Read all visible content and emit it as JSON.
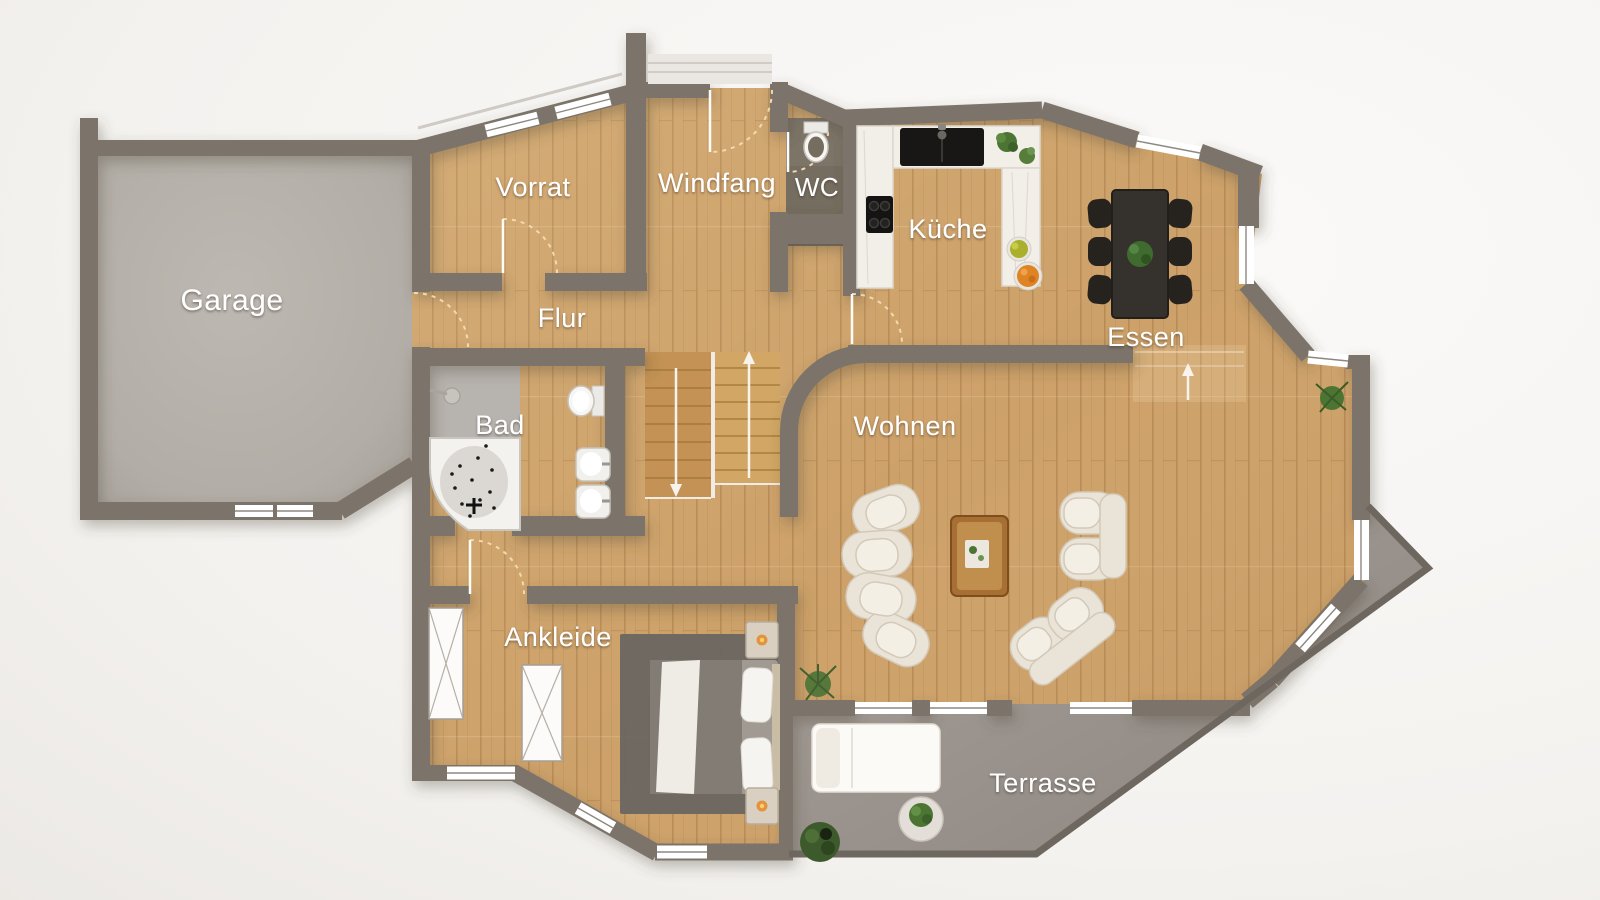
{
  "plan": {
    "type": "floor-plan",
    "floor": "ground-floor",
    "rooms": {
      "garage": {
        "label": "Garage"
      },
      "vorrat": {
        "label": "Vorrat"
      },
      "windfang": {
        "label": "Windfang"
      },
      "wc": {
        "label": "WC"
      },
      "kueche": {
        "label": "Küche"
      },
      "essen": {
        "label": "Essen"
      },
      "flur": {
        "label": "Flur"
      },
      "bad": {
        "label": "Bad"
      },
      "wohnen": {
        "label": "Wohnen"
      },
      "ankleide": {
        "label": "Ankleide"
      },
      "terrasse": {
        "label": "Terrasse"
      }
    },
    "icons": {
      "stairs_up_arrow": "up-arrow",
      "stairs_down_arrow": "down-arrow",
      "step_up_arrow": "up-arrow",
      "door_swing": "quarter-arc-dashed"
    },
    "colors": {
      "wall": "#7b736b",
      "wall_edge": "#6e675f",
      "wood_floor": "#cda169",
      "wood_plank_line": "#8a5d28",
      "garage_floor": "#b6b1aa",
      "terrace_floor": "#9b948d",
      "wc_floor": "#756d5f",
      "shower_floor": "#b7b3ae",
      "counter_marble": "#f2efe8",
      "appliance_black": "#181715",
      "dining_set": "#2e2b27",
      "sofa": "#eae3d7",
      "coffee_table": "#a76f33",
      "rug": "#6c6761",
      "label_text": "#ffffff",
      "door_arc": "#f2d9ae",
      "arrow": "#f8f4ed",
      "plant_green": "#4c7534",
      "candle_orange": "#e3933f"
    }
  }
}
